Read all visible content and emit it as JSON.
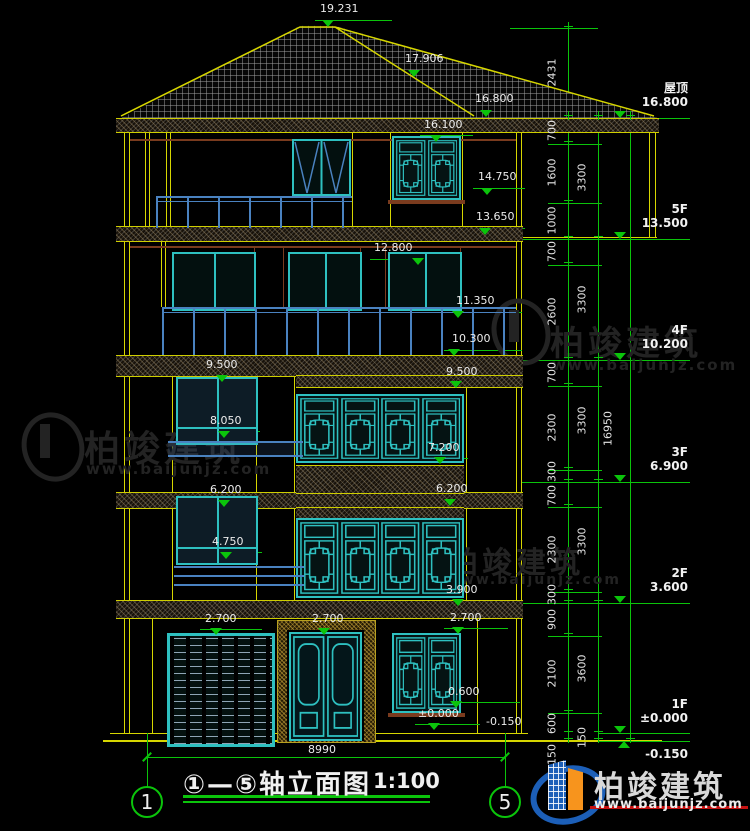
{
  "drawing": {
    "title": "①—⑤轴立面图",
    "scale": "1:100",
    "axis_left": "1",
    "axis_right": "5",
    "overall_width_mm": "8990"
  },
  "floors": [
    {
      "label": "屋顶",
      "elev": "16.800"
    },
    {
      "label": "5F",
      "elev": "13.500"
    },
    {
      "label": "4F",
      "elev": "10.200"
    },
    {
      "label": "3F",
      "elev": "6.900"
    },
    {
      "label": "2F",
      "elev": "3.600"
    },
    {
      "label": "1F",
      "elev": "±0.000"
    }
  ],
  "base_elevation": "-0.150",
  "dim_chain": {
    "segments": [
      "2431",
      "700",
      "1600",
      "1000",
      "700",
      "2600",
      "700",
      "2300",
      "300",
      "700",
      "2300",
      "300",
      "900",
      "2100",
      "600",
      "150"
    ],
    "floor_heights": [
      "3300",
      "3300",
      "3300",
      "3300",
      "3600",
      "150"
    ],
    "total": "16950"
  },
  "elevations": {
    "ridge": "19.231",
    "roof_break": "17.906",
    "eave": "16.800",
    "t16_100": "16.100",
    "t14_750": "14.750",
    "t13_650": "13.650",
    "t12_800": "12.800",
    "t11_350": "11.350",
    "t10_300": "10.300",
    "t9_500_r": "9.500",
    "t9_500_l": "9.500",
    "t8_050": "8.050",
    "t7_200": "7.200",
    "t6_200_l": "6.200",
    "t6_200_r": "6.200",
    "t4_750": "4.750",
    "t3_900": "3.900",
    "t2_700_garage": "2.700",
    "t2_700_door": "2.700",
    "t2_700_window": "2.700",
    "t0_600": "0.600",
    "t0_000": "±0.000",
    "t_minus_150": "-0.150"
  },
  "watermark": {
    "name": "柏竣建筑",
    "url": "www.baijunjz.com"
  },
  "brand": {
    "name": "柏竣建筑",
    "url": "www.baijunjz.com"
  }
}
